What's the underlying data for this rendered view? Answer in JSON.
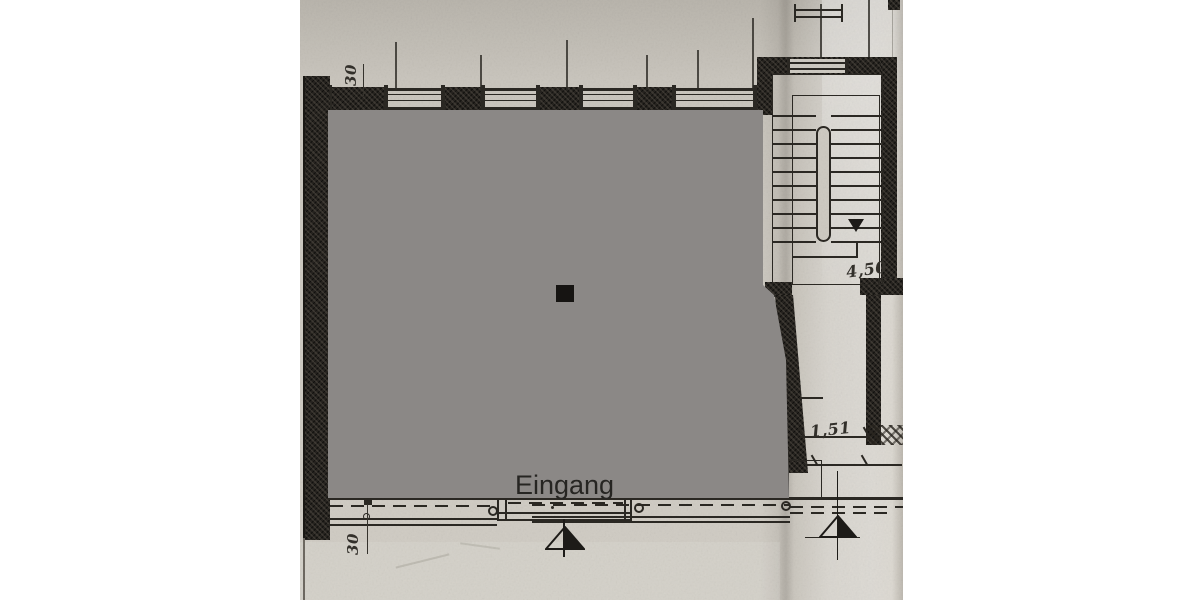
{
  "plan": {
    "entrance_label": "Eingang",
    "dimensions": {
      "top_wall_thickness": "30",
      "bottom_wall_thickness": "30",
      "staircase_depth": "4,50",
      "corridor_width": "1,51"
    },
    "symbols": {
      "stair_direction": "down-arrow",
      "entrance_marker": "half-filled-triangle"
    },
    "colors": {
      "canvas": "#ffffff",
      "paper": "#cdc9c1",
      "ink": "#2b2823",
      "wall": "#26231f",
      "privacy_overlay": "#8b8886",
      "privacy_square": "#151413"
    }
  }
}
